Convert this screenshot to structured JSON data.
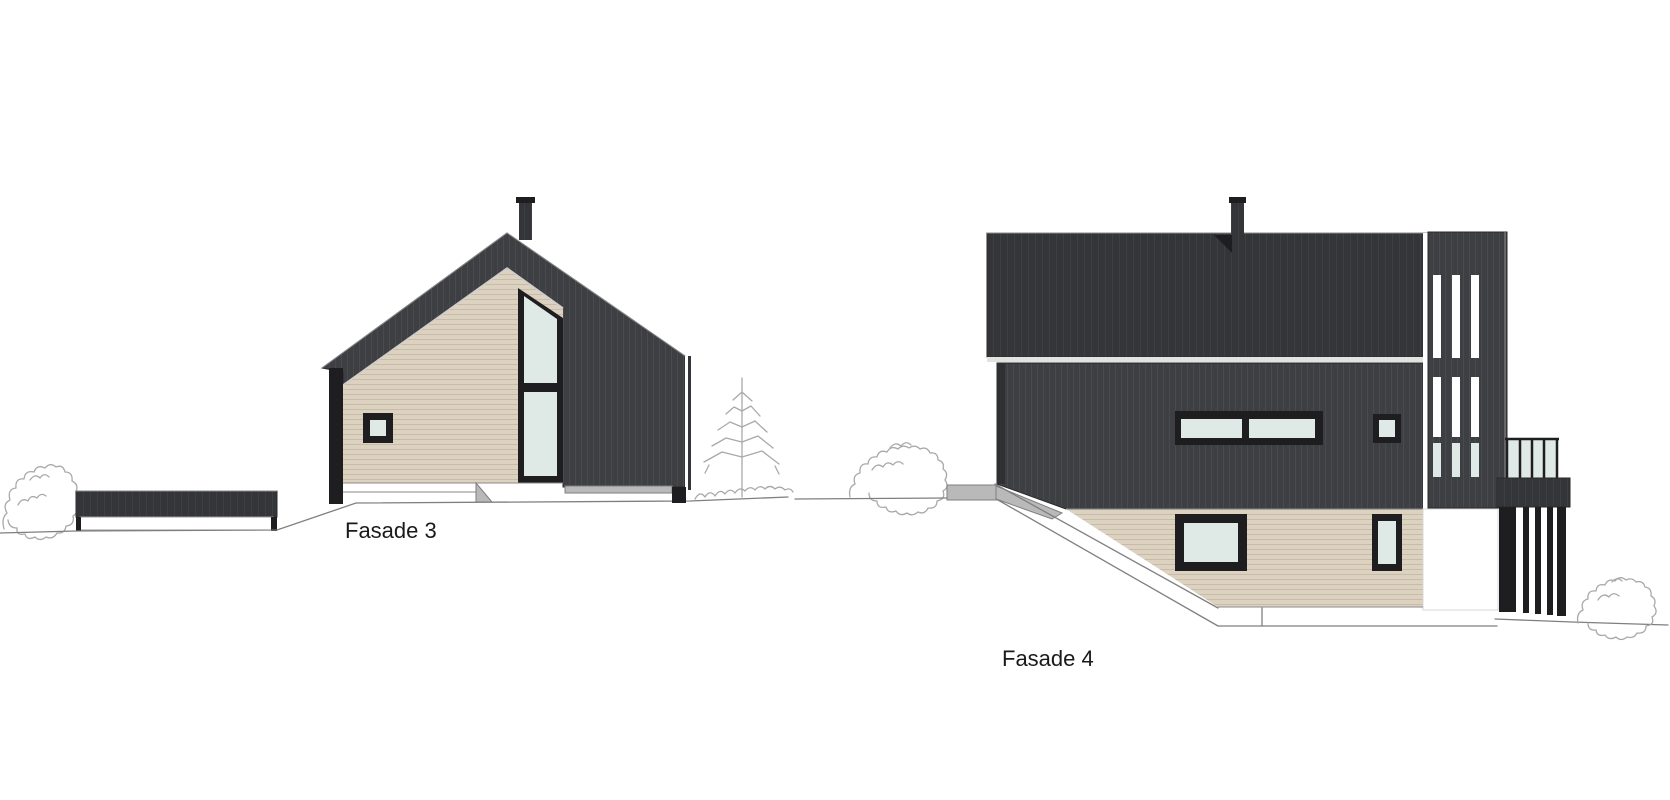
{
  "drawing": {
    "kind": "architectural facade elevations",
    "background": "#ffffff"
  },
  "labels": {
    "fasade3": "Fasade 3",
    "fasade4": "Fasade 4"
  },
  "colors": {
    "cladding_dark": "#3e3f42",
    "roof_dark": "#343538",
    "beige_siding": "#ddd1c0",
    "glass": "#dfe9e5",
    "window_frame": "#1e1e20",
    "sketch_gray": "#a9a9a9",
    "ground_gray": "#7f7f7f",
    "concrete_gray": "#b9b9b9",
    "label_text": "#1a1a1a"
  }
}
